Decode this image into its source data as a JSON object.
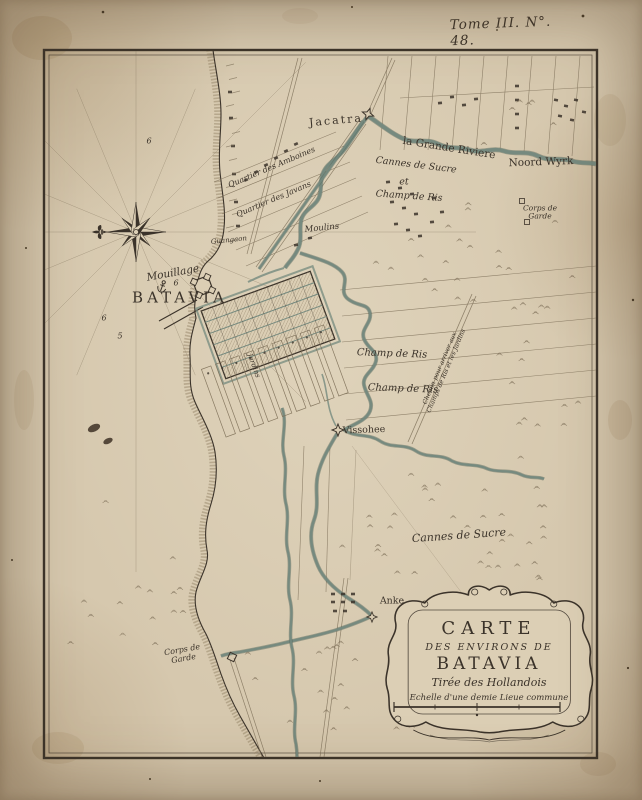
{
  "plate": {
    "text": "Tome III. N°. 48."
  },
  "cartouche": {
    "line1": "CARTE",
    "line2": "DES ENVIRONS DE",
    "line3": "BATAVIA",
    "subtitle": "Tirée des Hollandois",
    "scale_label": "Echelle d'une demie Lieue commune"
  },
  "icons": {
    "compass_north_icon": "fleur-de-lis",
    "anchorage_icon": "anchor",
    "fort_icon": "four-point-star"
  },
  "colors": {
    "paper": "#d6c8ae",
    "paper2": "#dbceb4",
    "ink": "#3b332a",
    "water": "#74897e",
    "water_dark": "#4f6157",
    "field": "#7d6f58",
    "hatch": "#9b8a6d"
  },
  "labels": [
    {
      "id": "jacatra",
      "text": "Jacatra",
      "x": 336,
      "y": 121,
      "rot": -5,
      "size": 11,
      "cls": "sp1"
    },
    {
      "id": "grande-riviere",
      "text": "la Grande Riviere",
      "x": 449,
      "y": 149,
      "rot": 9,
      "size": 10.5,
      "cls": ""
    },
    {
      "id": "noord-wyrk",
      "text": "Noord Wyrk",
      "x": 541,
      "y": 163,
      "rot": -2,
      "size": 10.5,
      "cls": ""
    },
    {
      "id": "quartier-amboines",
      "text": "Quartier des Amboines",
      "x": 272,
      "y": 168,
      "rot": -23,
      "size": 8,
      "cls": "it"
    },
    {
      "id": "quartier-javans",
      "text": "Quartier des Javans",
      "x": 274,
      "y": 200,
      "rot": -23,
      "size": 8,
      "cls": "it"
    },
    {
      "id": "guangaon",
      "text": "Guangaon",
      "x": 229,
      "y": 241,
      "rot": -6,
      "size": 7,
      "cls": "it"
    },
    {
      "id": "moulins",
      "text": "Moulins",
      "x": 322,
      "y": 229,
      "rot": -6,
      "size": 8.5,
      "cls": "it"
    },
    {
      "id": "cannes-sucre-1",
      "text": "Cannes de Sucre",
      "x": 416,
      "y": 166,
      "rot": 7,
      "size": 9.5,
      "cls": "it"
    },
    {
      "id": "et",
      "text": "et",
      "x": 404,
      "y": 183,
      "rot": 0,
      "size": 9.5,
      "cls": "it"
    },
    {
      "id": "champ-ris-1",
      "text": "Champ de Ris",
      "x": 409,
      "y": 197,
      "rot": 4,
      "size": 9.5,
      "cls": "it"
    },
    {
      "id": "corps-garde-ne",
      "text": "Corps de\nGarde",
      "x": 540,
      "y": 213,
      "rot": 0,
      "size": 7.5,
      "cls": "it"
    },
    {
      "id": "mouillage",
      "text": "Mouillage",
      "x": 173,
      "y": 274,
      "rot": -10,
      "size": 10.5,
      "cls": "it"
    },
    {
      "id": "batavia",
      "text": "BATAVIA",
      "x": 180,
      "y": 298,
      "rot": 0,
      "size": 15,
      "cls": "sp2"
    },
    {
      "id": "champ-ris-2",
      "text": "Champ de Ris",
      "x": 392,
      "y": 354,
      "rot": 2,
      "size": 10,
      "cls": "it"
    },
    {
      "id": "champ-ris-3",
      "text": "Champ de Ris",
      "x": 403,
      "y": 389,
      "rot": 2,
      "size": 10,
      "cls": "it"
    },
    {
      "id": "chemin",
      "text": "Chemin pour arriver aux\nChamps de Ris et les Jardins",
      "x": 444,
      "y": 370,
      "rot": -67,
      "size": 6.2,
      "cls": "it"
    },
    {
      "id": "vissohee",
      "text": "Vissohee",
      "x": 364,
      "y": 431,
      "rot": -2,
      "size": 9.5,
      "cls": ""
    },
    {
      "id": "jardins",
      "text": "Jardins",
      "x": 253,
      "y": 366,
      "rot": 70,
      "size": 7,
      "cls": "it"
    },
    {
      "id": "cannes-sucre-2",
      "text": "Cannes de Sucre",
      "x": 459,
      "y": 536,
      "rot": -4,
      "size": 11,
      "cls": "it"
    },
    {
      "id": "anke",
      "text": "Anke",
      "x": 392,
      "y": 602,
      "rot": 0,
      "size": 9.5,
      "cls": ""
    },
    {
      "id": "corps-garde-sw",
      "text": "Corps de\nGarde",
      "x": 183,
      "y": 655,
      "rot": -10,
      "size": 8,
      "cls": "it"
    },
    {
      "id": "sounding-1",
      "text": "6",
      "x": 149,
      "y": 142,
      "rot": 0,
      "size": 8,
      "cls": "it"
    },
    {
      "id": "sounding-2",
      "text": "6",
      "x": 176,
      "y": 284,
      "rot": 0,
      "size": 8,
      "cls": "it"
    },
    {
      "id": "sounding-3",
      "text": "6",
      "x": 104,
      "y": 319,
      "rot": 0,
      "size": 8,
      "cls": "it"
    },
    {
      "id": "sounding-4",
      "text": "5",
      "x": 120,
      "y": 337,
      "rot": 0,
      "size": 8,
      "cls": "it"
    }
  ]
}
